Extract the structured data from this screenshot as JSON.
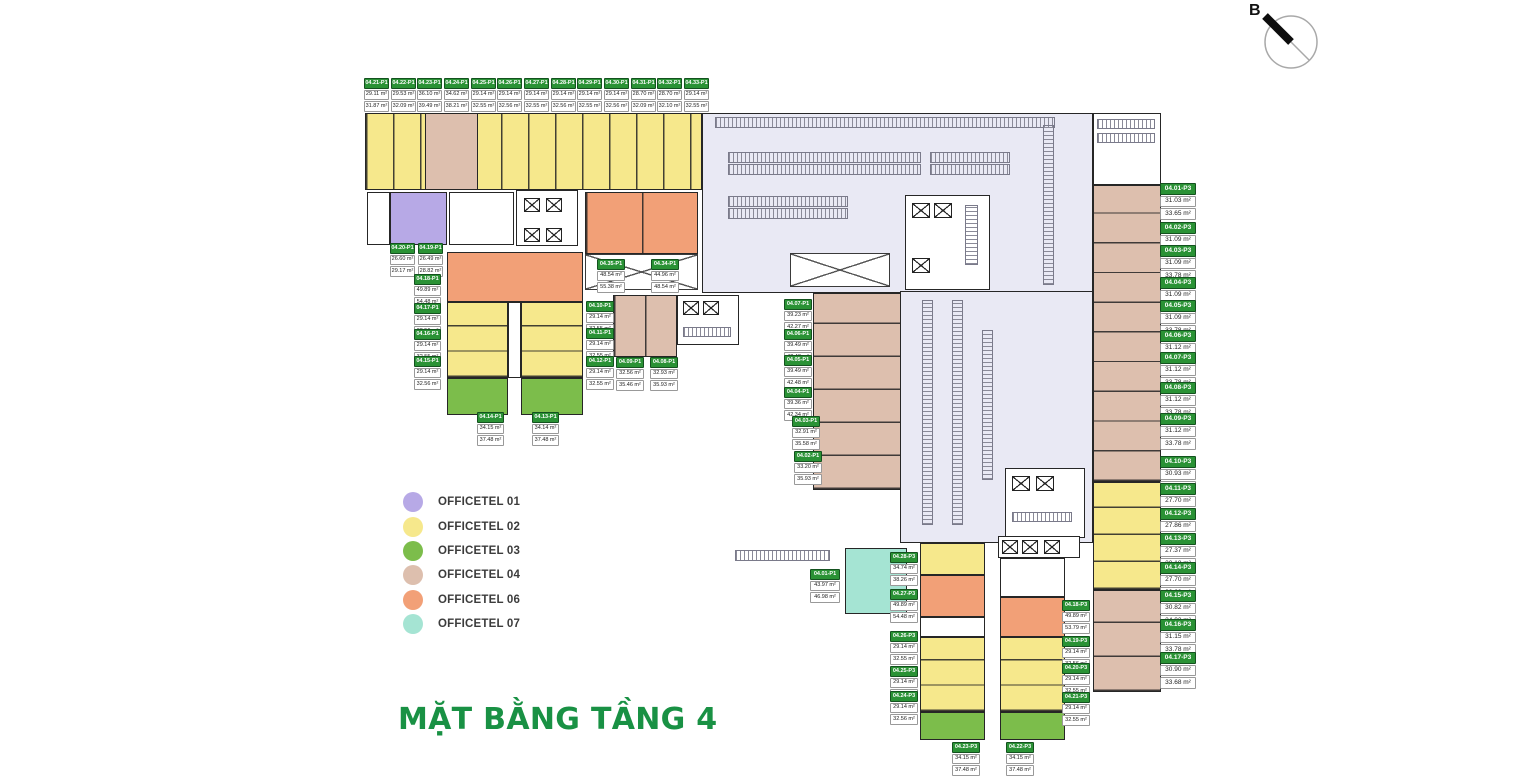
{
  "title": "MẶT BẰNG TẦNG 4",
  "compass": {
    "label": "B"
  },
  "colors": {
    "officetel01": "#b7a9e6",
    "officetel02": "#f6e88c",
    "officetel03": "#7cbd4b",
    "officetel04": "#ddbfae",
    "officetel06": "#f2a077",
    "officetel07": "#a5e4d3",
    "garage": "#e9e9f4",
    "label_green": "#2a9235",
    "title_green": "#199144"
  },
  "legend": {
    "items": [
      {
        "label": "OFFICETEL 01",
        "color_key": "officetel01"
      },
      {
        "label": "OFFICETEL 02",
        "color_key": "officetel02"
      },
      {
        "label": "OFFICETEL 03",
        "color_key": "officetel03"
      },
      {
        "label": "OFFICETEL 04",
        "color_key": "officetel04"
      },
      {
        "label": "OFFICETEL 06",
        "color_key": "officetel06"
      },
      {
        "label": "OFFICETEL 07",
        "color_key": "officetel07"
      }
    ]
  },
  "units": [
    {
      "id": "04.21-P1",
      "area1": "29.11 m²",
      "area2": "31.87 m²",
      "x": 364,
      "y": 78
    },
    {
      "id": "04.22-P1",
      "area1": "29.53 m²",
      "area2": "32.09 m²",
      "x": 391,
      "y": 78
    },
    {
      "id": "04.23-P1",
      "area1": "36.10 m²",
      "area2": "39.49 m²",
      "x": 417,
      "y": 78
    },
    {
      "id": "04.24-P1",
      "area1": "34.62 m²",
      "area2": "38.21 m²",
      "x": 444,
      "y": 78
    },
    {
      "id": "04.25-P1",
      "area1": "29.14 m²",
      "area2": "32.55 m²",
      "x": 471,
      "y": 78
    },
    {
      "id": "04.26-P1",
      "area1": "29.14 m²",
      "area2": "32.56 m²",
      "x": 497,
      "y": 78
    },
    {
      "id": "04.27-P1",
      "area1": "29.14 m²",
      "area2": "32.55 m²",
      "x": 524,
      "y": 78
    },
    {
      "id": "04.28-P1",
      "area1": "29.14 m²",
      "area2": "32.56 m²",
      "x": 551,
      "y": 78
    },
    {
      "id": "04.29-P1",
      "area1": "29.14 m²",
      "area2": "32.55 m²",
      "x": 577,
      "y": 78
    },
    {
      "id": "04.30-P1",
      "area1": "29.14 m²",
      "area2": "32.56 m²",
      "x": 604,
      "y": 78
    },
    {
      "id": "04.31-P1",
      "area1": "28.70 m²",
      "area2": "32.09 m²",
      "x": 631,
      "y": 78
    },
    {
      "id": "04.32-P1",
      "area1": "28.70 m²",
      "area2": "32.10 m²",
      "x": 657,
      "y": 78
    },
    {
      "id": "04.33-P1",
      "area1": "29.14 m²",
      "area2": "32.55 m²",
      "x": 684,
      "y": 78
    },
    {
      "id": "04.20-P1",
      "area1": "26.60 m²",
      "area2": "29.17 m²",
      "x": 390,
      "y": 243
    },
    {
      "id": "04.19-P1",
      "area1": "26.49 m²",
      "area2": "28.82 m²",
      "x": 418,
      "y": 243
    },
    {
      "id": "04.18-P1",
      "area1": "49.89 m²",
      "area2": "54.48 m²",
      "x": 414,
      "y": 274,
      "w": 27
    },
    {
      "id": "04.17-P1",
      "area1": "29.14 m²",
      "area2": "32.56 m²",
      "x": 414,
      "y": 303,
      "w": 27
    },
    {
      "id": "04.16-P1",
      "area1": "29.14 m²",
      "area2": "32.55 m²",
      "x": 414,
      "y": 329,
      "w": 27
    },
    {
      "id": "04.15-P1",
      "area1": "29.14 m²",
      "area2": "32.56 m²",
      "x": 414,
      "y": 356,
      "w": 27
    },
    {
      "id": "04.14-P1",
      "area1": "34.15 m²",
      "area2": "37.48 m²",
      "x": 477,
      "y": 412,
      "w": 27
    },
    {
      "id": "04.13-P1",
      "area1": "34.14 m²",
      "area2": "37.48 m²",
      "x": 532,
      "y": 412,
      "w": 27
    },
    {
      "id": "04.35-P1",
      "area1": "48.54 m²",
      "area2": "55.38 m²",
      "x": 597,
      "y": 259,
      "w": 28
    },
    {
      "id": "04.34-P1",
      "area1": "44.96 m²",
      "area2": "48.54 m²",
      "x": 651,
      "y": 259,
      "w": 28
    },
    {
      "id": "04.10-P1",
      "area1": "29.14 m²",
      "area2": "32.55 m²",
      "x": 586,
      "y": 301,
      "w": 28
    },
    {
      "id": "04.11-P1",
      "area1": "29.14 m²",
      "area2": "32.55 m²",
      "x": 586,
      "y": 328,
      "w": 28
    },
    {
      "id": "04.12-P1",
      "area1": "29.14 m²",
      "area2": "32.55 m²",
      "x": 586,
      "y": 356,
      "w": 28
    },
    {
      "id": "04.09-P1",
      "area1": "32.56 m²",
      "area2": "35.46 m²",
      "x": 616,
      "y": 357,
      "w": 28
    },
    {
      "id": "04.08-P1",
      "area1": "32.93 m²",
      "area2": "35.93 m²",
      "x": 650,
      "y": 357,
      "w": 28
    },
    {
      "id": "04.07-P1",
      "area1": "39.23 m²",
      "area2": "42.27 m²",
      "x": 784,
      "y": 299,
      "w": 28
    },
    {
      "id": "04.06-P1",
      "area1": "39.49 m²",
      "area2": "42.48 m²",
      "x": 784,
      "y": 329,
      "w": 28
    },
    {
      "id": "04.05-P1",
      "area1": "39.49 m²",
      "area2": "42.48 m²",
      "x": 784,
      "y": 355,
      "w": 28
    },
    {
      "id": "04.04-P1",
      "area1": "39.36 m²",
      "area2": "42.34 m²",
      "x": 784,
      "y": 387,
      "w": 28
    },
    {
      "id": "04.03-P1",
      "area1": "32.91 m²",
      "area2": "35.58 m²",
      "x": 792,
      "y": 416,
      "w": 28
    },
    {
      "id": "04.02-P1",
      "area1": "33.20 m²",
      "area2": "35.93 m²",
      "x": 794,
      "y": 451,
      "w": 28
    },
    {
      "id": "04.01-P1",
      "area1": "43.97 m²",
      "area2": "46.98 m²",
      "x": 810,
      "y": 569,
      "w": 30
    },
    {
      "id": "04.28-P3",
      "area1": "34.74 m²",
      "area2": "38.26 m²",
      "x": 890,
      "y": 552,
      "w": 28
    },
    {
      "id": "04.27-P3",
      "area1": "49.89 m²",
      "area2": "54.48 m²",
      "x": 890,
      "y": 589,
      "w": 28
    },
    {
      "id": "04.26-P3",
      "area1": "29.14 m²",
      "area2": "32.55 m²",
      "x": 890,
      "y": 631,
      "w": 28
    },
    {
      "id": "04.25-P3",
      "area1": "29.14 m²",
      "area2": "32.56 m²",
      "x": 890,
      "y": 666,
      "w": 28
    },
    {
      "id": "04.24-P3",
      "area1": "29.14 m²",
      "area2": "32.56 m²",
      "x": 890,
      "y": 691,
      "w": 28
    },
    {
      "id": "04.23-P3",
      "area1": "34.15 m²",
      "area2": "37.48 m²",
      "x": 952,
      "y": 742,
      "w": 28
    },
    {
      "id": "04.22-P3",
      "area1": "34.15 m²",
      "area2": "37.48 m²",
      "x": 1006,
      "y": 742,
      "w": 28
    },
    {
      "id": "04.18-P3",
      "area1": "49.89 m²",
      "area2": "53.79 m²",
      "x": 1062,
      "y": 600,
      "w": 28
    },
    {
      "id": "04.19-P3",
      "area1": "29.14 m²",
      "area2": "32.56 m²",
      "x": 1062,
      "y": 636,
      "w": 28
    },
    {
      "id": "04.20-P3",
      "area1": "29.14 m²",
      "area2": "32.55 m²",
      "x": 1062,
      "y": 663,
      "w": 28
    },
    {
      "id": "04.21-P3",
      "area1": "29.14 m²",
      "area2": "32.55 m²",
      "x": 1062,
      "y": 692,
      "w": 28
    },
    {
      "id": "04.01-P3",
      "area1": "31.03 m²",
      "area2": "33.65 m²",
      "x": 1160,
      "y": 183,
      "w": 36,
      "fs": 6.5
    },
    {
      "id": "04.02-P3",
      "area1": "31.09 m²",
      "area2": "33.78 m²",
      "x": 1160,
      "y": 222,
      "w": 36,
      "fs": 6.5
    },
    {
      "id": "04.03-P3",
      "area1": "31.09 m²",
      "area2": "33.78 m²",
      "x": 1160,
      "y": 245,
      "w": 36,
      "fs": 6.5
    },
    {
      "id": "04.04-P3",
      "area1": "31.09 m²",
      "area2": "33.78 m²",
      "x": 1160,
      "y": 277,
      "w": 36,
      "fs": 6.5
    },
    {
      "id": "04.05-P3",
      "area1": "31.09 m²",
      "area2": "33.78 m²",
      "x": 1160,
      "y": 300,
      "w": 36,
      "fs": 6.5
    },
    {
      "id": "04.06-P3",
      "area1": "31.12 m²",
      "area2": "33.78 m²",
      "x": 1160,
      "y": 330,
      "w": 36,
      "fs": 6.5
    },
    {
      "id": "04.07-P3",
      "area1": "31.12 m²",
      "area2": "33.78 m²",
      "x": 1160,
      "y": 352,
      "w": 36,
      "fs": 6.5
    },
    {
      "id": "04.08-P3",
      "area1": "31.12 m²",
      "area2": "33.78 m²",
      "x": 1160,
      "y": 382,
      "w": 36,
      "fs": 6.5
    },
    {
      "id": "04.09-P3",
      "area1": "31.12 m²",
      "area2": "33.78 m²",
      "x": 1160,
      "y": 413,
      "w": 36,
      "fs": 6.5
    },
    {
      "id": "04.10-P3",
      "area1": "30.93 m²",
      "area2": "34.02 m²",
      "x": 1160,
      "y": 456,
      "w": 36,
      "fs": 6.5
    },
    {
      "id": "04.11-P3",
      "area1": "27.70 m²",
      "area2": "30.63 m²",
      "x": 1160,
      "y": 483,
      "w": 36,
      "fs": 6.5
    },
    {
      "id": "04.12-P3",
      "area1": "27.86 m²",
      "area2": "30.79 m²",
      "x": 1160,
      "y": 508,
      "w": 36,
      "fs": 6.5
    },
    {
      "id": "04.13-P3",
      "area1": "27.37 m²",
      "area2": "30.18 m²",
      "x": 1160,
      "y": 533,
      "w": 36,
      "fs": 6.5
    },
    {
      "id": "04.14-P3",
      "area1": "27.70 m²",
      "area2": "30.63 m²",
      "x": 1160,
      "y": 562,
      "w": 36,
      "fs": 6.5
    },
    {
      "id": "04.15-P3",
      "area1": "30.82 m²",
      "area2": "34.02 m²",
      "x": 1160,
      "y": 590,
      "w": 36,
      "fs": 6.5
    },
    {
      "id": "04.16-P3",
      "area1": "31.15 m²",
      "area2": "33.78 m²",
      "x": 1160,
      "y": 619,
      "w": 36,
      "fs": 6.5
    },
    {
      "id": "04.17-P3",
      "area1": "30.90 m²",
      "area2": "33.68 m²",
      "x": 1160,
      "y": 652,
      "w": 36,
      "fs": 6.5
    }
  ]
}
